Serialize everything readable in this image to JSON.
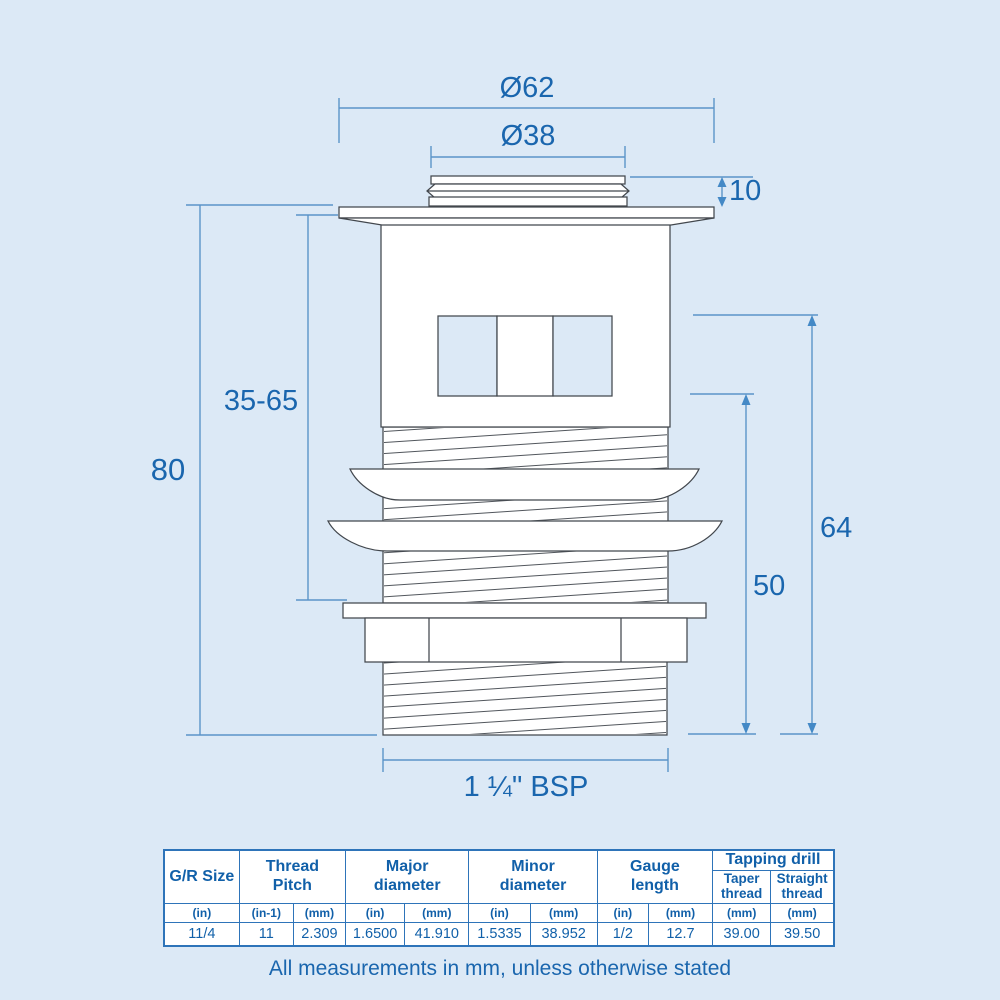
{
  "colors": {
    "background": "#dce9f6",
    "drawing_line": "#42474d",
    "dimension_line": "#5b94c9",
    "dimension_text": "#1a66ae",
    "table_border": "#2e74b9",
    "table_text": "#1160a9",
    "shape_fill": "#ffffff"
  },
  "drawing": {
    "dim_outer_diameter": "Ø62",
    "dim_inner_diameter": "Ø38",
    "dim_cap_height": "10",
    "dim_overall_length": "80",
    "dim_adjustable_range": "35-65",
    "dim_thread_length_outer": "64",
    "dim_thread_length_inner": "50",
    "dim_thread_size": "1 ¼\" BSP"
  },
  "table": {
    "header": {
      "gr_size": "G/R Size",
      "thread_pitch": "Thread\nPitch",
      "major_diameter": "Major\ndiameter",
      "minor_diameter": "Minor\ndiameter",
      "gauge_length": "Gauge\nlength",
      "tapping_drill": "Tapping drill",
      "taper_thread": "Taper\nthread",
      "straight_thread": "Straight\nthread"
    },
    "units": [
      "(in)",
      "(in-1)",
      "(mm)",
      "(in)",
      "(mm)",
      "(in)",
      "(mm)",
      "(in)",
      "(mm)",
      "(mm)",
      "(mm)"
    ],
    "values": [
      "11/4",
      "11",
      "2.309",
      "1.6500",
      "41.910",
      "1.5335",
      "38.952",
      "1/2",
      "12.7",
      "39.00",
      "39.50"
    ]
  },
  "footer": {
    "note": "All measurements in mm, unless otherwise stated"
  }
}
